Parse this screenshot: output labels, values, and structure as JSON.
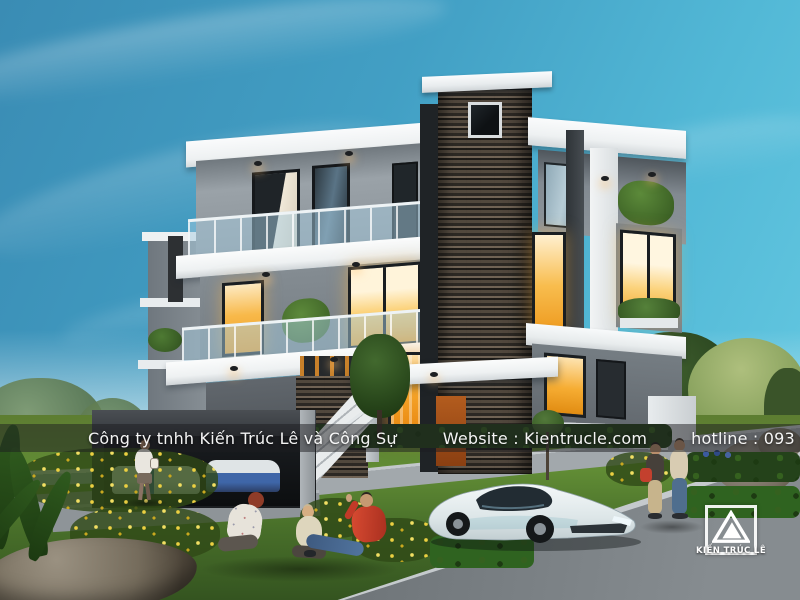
{
  "scene": {
    "description": "3D exterior render of a modern three-storey villa at dusk with lit windows, stone feature tower, lawn, supercar parked on the street and pedestrians",
    "palette": {
      "sky_top": "#3A8CB4",
      "sky_light": "#67CBE3",
      "warm_window": "#F5A42C",
      "slab_white": "#F2F4F5",
      "stone_dark": "#35312C",
      "grass": "#5D8A33",
      "road": "#6C7276"
    }
  },
  "watermark": {
    "company": "Công ty tnhh Kiến Trúc Lê và Công Sự",
    "website": "Website : Kientrucle.com",
    "hotline": "hotline : 093 999 1981"
  },
  "logo": {
    "label": "KIẾN TRÚC LÊ"
  }
}
